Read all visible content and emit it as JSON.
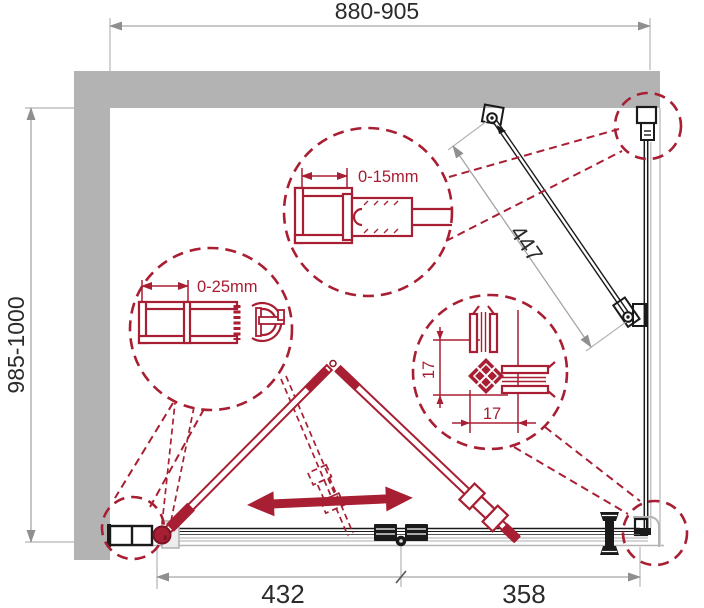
{
  "colors": {
    "red": "#a81e32",
    "wall": "#b3b3b3",
    "dim": "#a6a6a6",
    "ink": "#1a1a1a"
  },
  "dimensions": {
    "overall_width": "880-905",
    "overall_depth": "985-1000",
    "support_bar_length": "447",
    "door_section_width": "432",
    "fixed_section_width": "358"
  },
  "details": {
    "wall_profile_top": {
      "label": "0-15mm"
    },
    "wall_profile_left": {
      "label": "0-25mm"
    },
    "corner_profile": {
      "vertical_label": "17",
      "horizontal_label": "17"
    }
  }
}
